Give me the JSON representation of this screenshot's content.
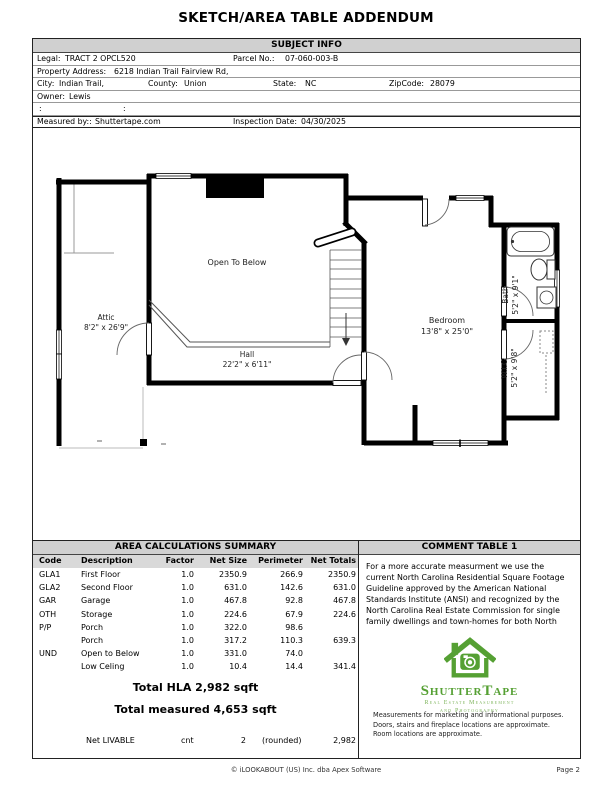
{
  "page": {
    "title": "SKETCH/AREA TABLE ADDENDUM",
    "footer_center": "© iLOOKABOUT (US) Inc. dba Apex Software",
    "footer_right": "Page 2"
  },
  "subject_info": {
    "header": "SUBJECT INFO",
    "legal_label": "Legal:",
    "legal": "TRACT 2 OPCL520",
    "parcel_label": "Parcel No.:",
    "parcel": "07-060-003-B",
    "address_label": "Property Address:",
    "address": "6218 Indian Trail Fairview Rd,",
    "city_label": "City:",
    "city": "Indian Trail,",
    "county_label": "County:",
    "county": "Union",
    "state_label": "State:",
    "state": "NC",
    "zip_label": "ZipCode:",
    "zip": "28079",
    "owner_label": "Owner:",
    "owner": "Lewis",
    "colon": ":",
    "measured_label": "Measured by::",
    "measured": "Shuttertape.com",
    "inspection_label": "Inspection Date:",
    "inspection": "04/30/2025"
  },
  "sketch": {
    "rooms": [
      {
        "name": "Attic",
        "dims": "8'2\" x 26'9\""
      },
      {
        "name": "Open To Below",
        "dims": ""
      },
      {
        "name": "Hall",
        "dims": "22'2\" x 6'11\""
      },
      {
        "name": "Bedroom",
        "dims": "13'8\" x 25'0\""
      },
      {
        "name": "Bath",
        "dims": "5'2\" x 9'1\""
      },
      {
        "name": "W.I.C.",
        "dims": "5'2\" x 9'8\""
      }
    ]
  },
  "area_table": {
    "header": "AREA CALCULATIONS SUMMARY",
    "columns": [
      "Code",
      "Description",
      "Factor",
      "Net Size",
      "Perimeter",
      "Net Totals"
    ],
    "rows": [
      [
        "GLA1",
        "First Floor",
        "1.0",
        "2350.9",
        "266.9",
        "2350.9"
      ],
      [
        "GLA2",
        "Second Floor",
        "1.0",
        "631.0",
        "142.6",
        "631.0"
      ],
      [
        "GAR",
        "Garage",
        "1.0",
        "467.8",
        "92.8",
        "467.8"
      ],
      [
        "OTH",
        "Storage",
        "1.0",
        "224.6",
        "67.9",
        "224.6"
      ],
      [
        "P/P",
        "Porch",
        "1.0",
        "322.0",
        "98.6",
        ""
      ],
      [
        "",
        "Porch",
        "1.0",
        "317.2",
        "110.3",
        "639.3"
      ],
      [
        "UND",
        "Open to Below",
        "1.0",
        "331.0",
        "74.0",
        ""
      ],
      [
        "",
        "Low Celing",
        "1.0",
        "10.4",
        "14.4",
        "341.4"
      ]
    ],
    "total_hla": "Total HLA 2,982 sqft",
    "total_measured": "Total measured 4,653 sqft",
    "net_row": {
      "label": "Net LIVABLE",
      "unit": "cnt",
      "count": "2",
      "note": "(rounded)",
      "value": "2,982"
    }
  },
  "comment_table": {
    "header": "COMMENT TABLE 1",
    "text": "For a more accurate measurment we use the current North Carolina Residential Square Footage Guideline approved by the American National Standards Institute (ANSI) and recognized by the North Carolina Real Estate Commission for single family dwellings and town-homes for both North",
    "logo": {
      "brand": "ShutterTape",
      "tagline1": "Real Estate Measurement",
      "tagline2": "and Photography",
      "green": "#55a033"
    },
    "disclaimer": [
      "Measurements for marketing and informational purposes.",
      "Doors, stairs and fireplace locations are approximate.",
      "Room locations are approximate."
    ]
  }
}
